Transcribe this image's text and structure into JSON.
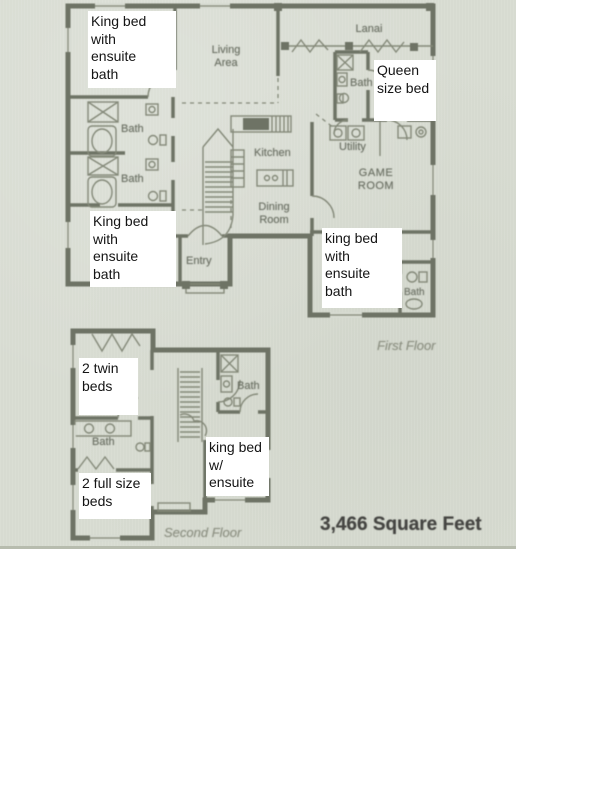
{
  "scan": {
    "background_color": "#d7dbd1",
    "wall_color": "#6e7365",
    "fixture_line_color": "#848979",
    "room_label_color": "#6d7266",
    "caption_color": "#8d9183",
    "annotation_bg": "#ffffff",
    "annotation_text_color": "#141414",
    "sqft_color": "#454542",
    "sqft_text": "3,466 Square Feet"
  },
  "first_floor": {
    "caption": "First Floor",
    "room_labels": [
      {
        "id": "living-area",
        "text": "Living\nArea"
      },
      {
        "id": "lanai",
        "text": "Lanai"
      },
      {
        "id": "bath-queen-suite",
        "text": "Bath"
      },
      {
        "id": "utility",
        "text": "Utility"
      },
      {
        "id": "game-room",
        "text": "GAME\nROOM"
      },
      {
        "id": "kitchen",
        "text": "Kitchen"
      },
      {
        "id": "bath-upper-left",
        "text": "Bath"
      },
      {
        "id": "bath-lower-left",
        "text": "Bath"
      },
      {
        "id": "dining-room",
        "text": "Dining\nRoom"
      },
      {
        "id": "entry",
        "text": "Entry"
      },
      {
        "id": "bath-bottom-right",
        "text": "Bath"
      }
    ],
    "annotations": [
      {
        "id": "king-bed-top-left",
        "text": "King bed\nwith\nensuite\nbath"
      },
      {
        "id": "queen-bed",
        "text": "Queen\nsize bed"
      },
      {
        "id": "king-bed-lower-left",
        "text": "King bed\nwith\nensuite\nbath"
      },
      {
        "id": "king-bed-lower-right",
        "text": "king bed\nwith\nensuite\nbath"
      }
    ]
  },
  "second_floor": {
    "caption": "Second Floor",
    "room_labels": [
      {
        "id": "bath-upper-right",
        "text": "Bath"
      },
      {
        "id": "bath-left",
        "text": "Bath"
      }
    ],
    "annotations": [
      {
        "id": "two-twin-beds",
        "text": "2 twin\nbeds"
      },
      {
        "id": "king-bed-ensuite",
        "text": "king bed\nw/\nensuite"
      },
      {
        "id": "two-full-size-beds",
        "text": "2 full size\nbeds"
      }
    ]
  }
}
